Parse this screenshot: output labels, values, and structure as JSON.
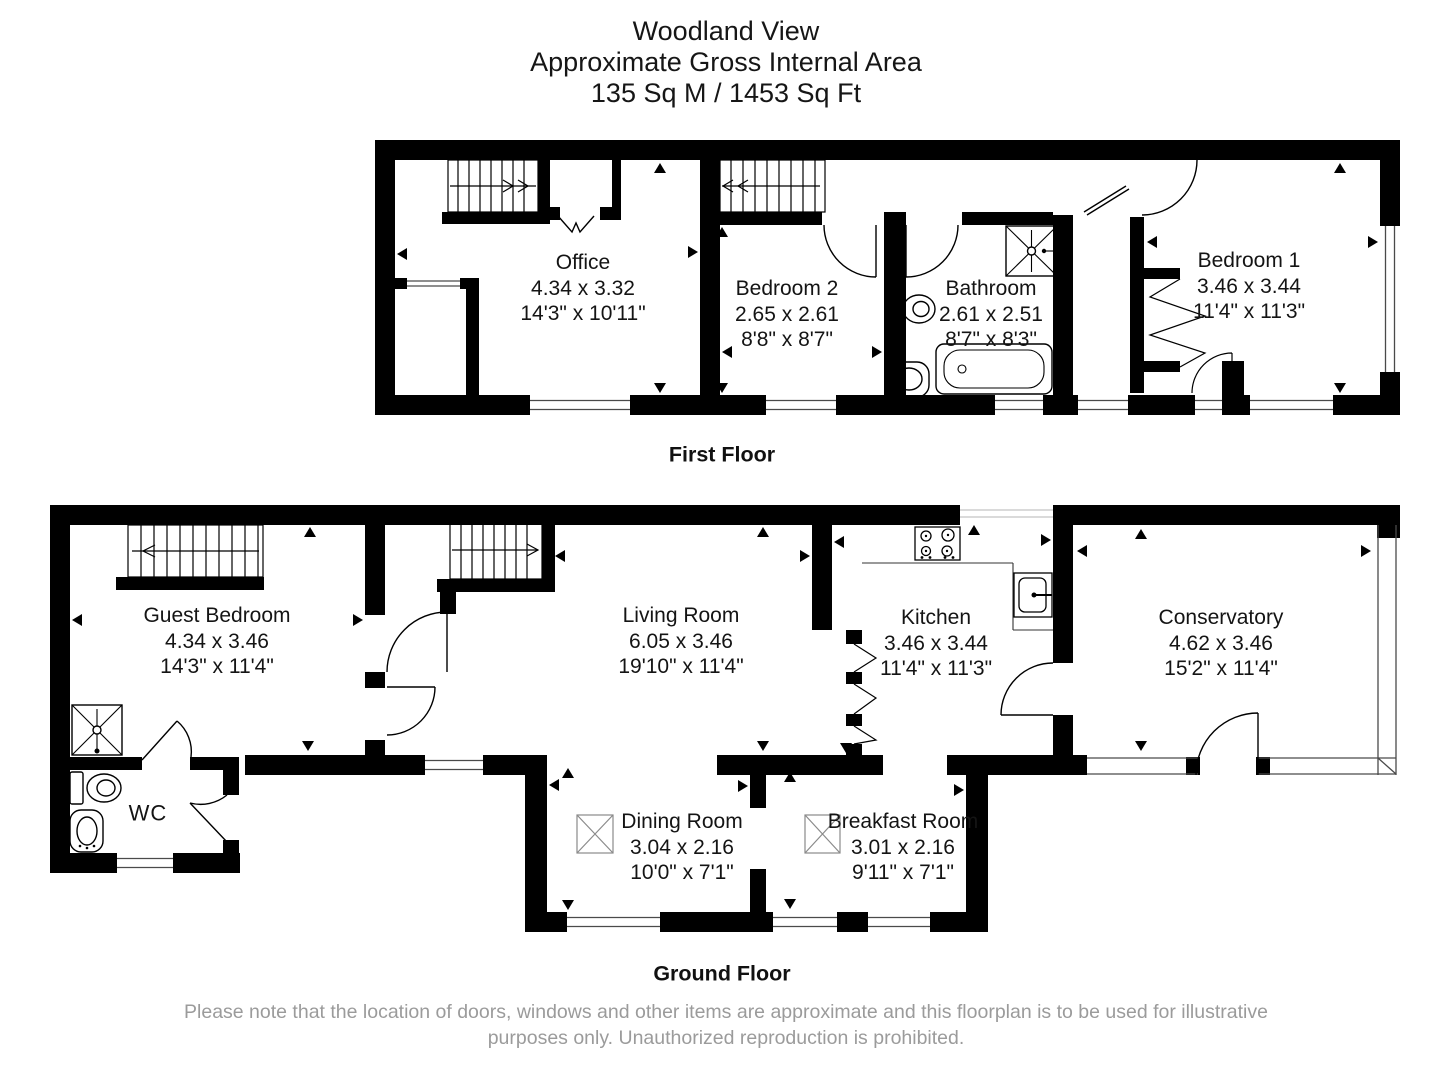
{
  "page": {
    "title_lines": [
      "Woodland View",
      "Approximate Gross Internal Area",
      "135 Sq M / 1453 Sq Ft"
    ],
    "disclaimer": "Please note that the location of doors, windows and other items are approximate and this floorplan is to be used for illustrative purposes only. Unauthorized reproduction is prohibited."
  },
  "floors": {
    "first": {
      "label": "First Floor"
    },
    "ground": {
      "label": "Ground Floor"
    }
  },
  "rooms": {
    "office": {
      "name": "Office",
      "metric": "4.34 x 3.32",
      "imperial": "14'3\" x 10'11\""
    },
    "bedroom2": {
      "name": "Bedroom 2",
      "metric": "2.65 x 2.61",
      "imperial": "8'8\" x 8'7\""
    },
    "bathroom": {
      "name": "Bathroom",
      "metric": "2.61 x 2.51",
      "imperial": "8'7\" x 8'3\""
    },
    "bedroom1": {
      "name": "Bedroom 1",
      "metric": "3.46 x 3.44",
      "imperial": "11'4\" x 11'3\""
    },
    "guest_bedroom": {
      "name": "Guest Bedroom",
      "metric": "4.34 x 3.46",
      "imperial": "14'3\" x 11'4\""
    },
    "living_room": {
      "name": "Living Room",
      "metric": "6.05 x 3.46",
      "imperial": "19'10\" x 11'4\""
    },
    "kitchen": {
      "name": "Kitchen",
      "metric": "3.46 x 3.44",
      "imperial": "11'4\" x 11'3\""
    },
    "conservatory": {
      "name": "Conservatory",
      "metric": "4.62 x 3.46",
      "imperial": "15'2\" x 11'4\""
    },
    "dining_room": {
      "name": "Dining Room",
      "metric": "3.04 x 2.16",
      "imperial": "10'0\" x 7'1\""
    },
    "breakfast_room": {
      "name": "Breakfast Room",
      "metric": "3.01 x 2.16",
      "imperial": "9'11\" x 7'1\""
    },
    "wc": {
      "name": "WC"
    }
  },
  "colors": {
    "wall": "#000000",
    "glazing": "#4a4a4a",
    "disclaimer_text": "#9b9b9b"
  }
}
